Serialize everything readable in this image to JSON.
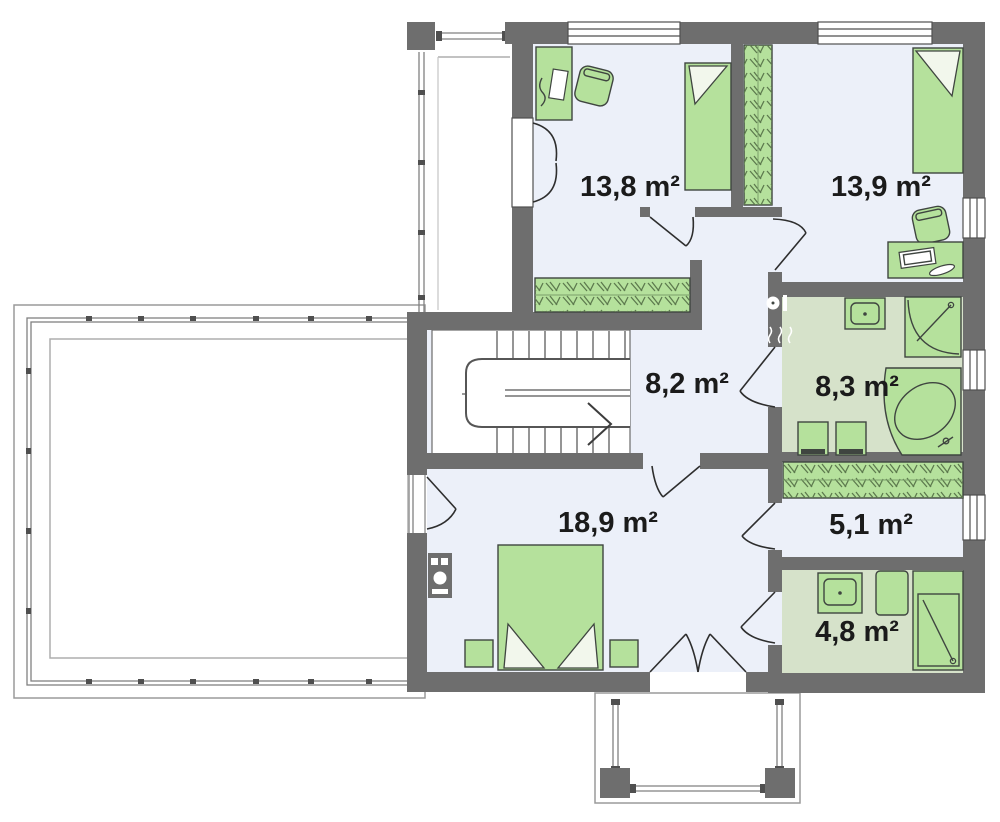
{
  "plan": {
    "rooms": [
      {
        "id": "bedroom-top-left",
        "area": "13,8 m²"
      },
      {
        "id": "bedroom-top-right",
        "area": "13,9 m²"
      },
      {
        "id": "hall-stairs",
        "area": "8,2 m²"
      },
      {
        "id": "bathroom-main",
        "area": "8,3 m²"
      },
      {
        "id": "master-bedroom",
        "area": "18,9 m²"
      },
      {
        "id": "walk-in-closet",
        "area": "5,1 m²"
      },
      {
        "id": "bathroom-small",
        "area": "4,8 m²"
      }
    ],
    "colors": {
      "wall": "#6e6e6e",
      "floor": "#ecf0f9",
      "bathroom_floor": "#d6e2ca",
      "furniture": "#b5e19c",
      "outline": "#3f4540",
      "label": "#1b1b1b"
    }
  }
}
